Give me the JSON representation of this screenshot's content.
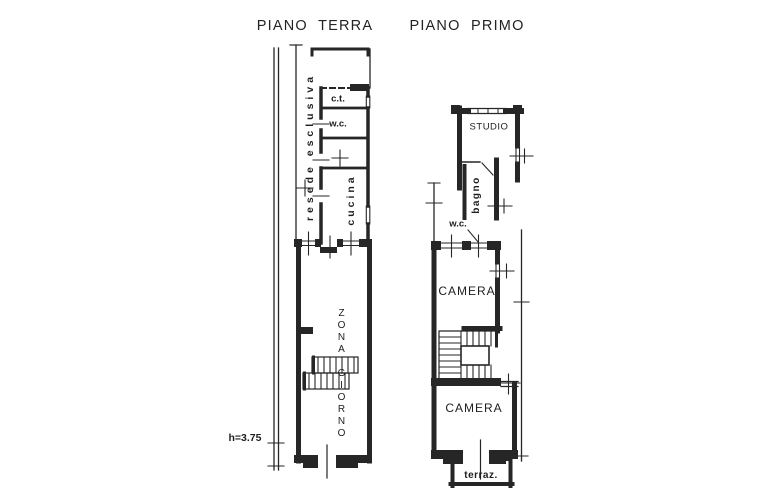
{
  "colors": {
    "background": "#ffffff",
    "line": "#262626",
    "text": "#1e1e1e"
  },
  "titles": {
    "ground_floor": "PIANO  TERRA",
    "first_floor": "PIANO  PRIMO"
  },
  "ground_floor": {
    "resede": "resede esclusiva",
    "ct": "c.t.",
    "wc": "w.c.",
    "cucina": "cucina",
    "zona_giorno": "ZONA GIORNO",
    "height_note": "h=3.75"
  },
  "first_floor": {
    "studio": "STUDIO",
    "bagno": "bagno",
    "wc": "w.c.",
    "camera_1": "CAMERA",
    "camera_2": "CAMERA",
    "terrace": "terraz."
  }
}
